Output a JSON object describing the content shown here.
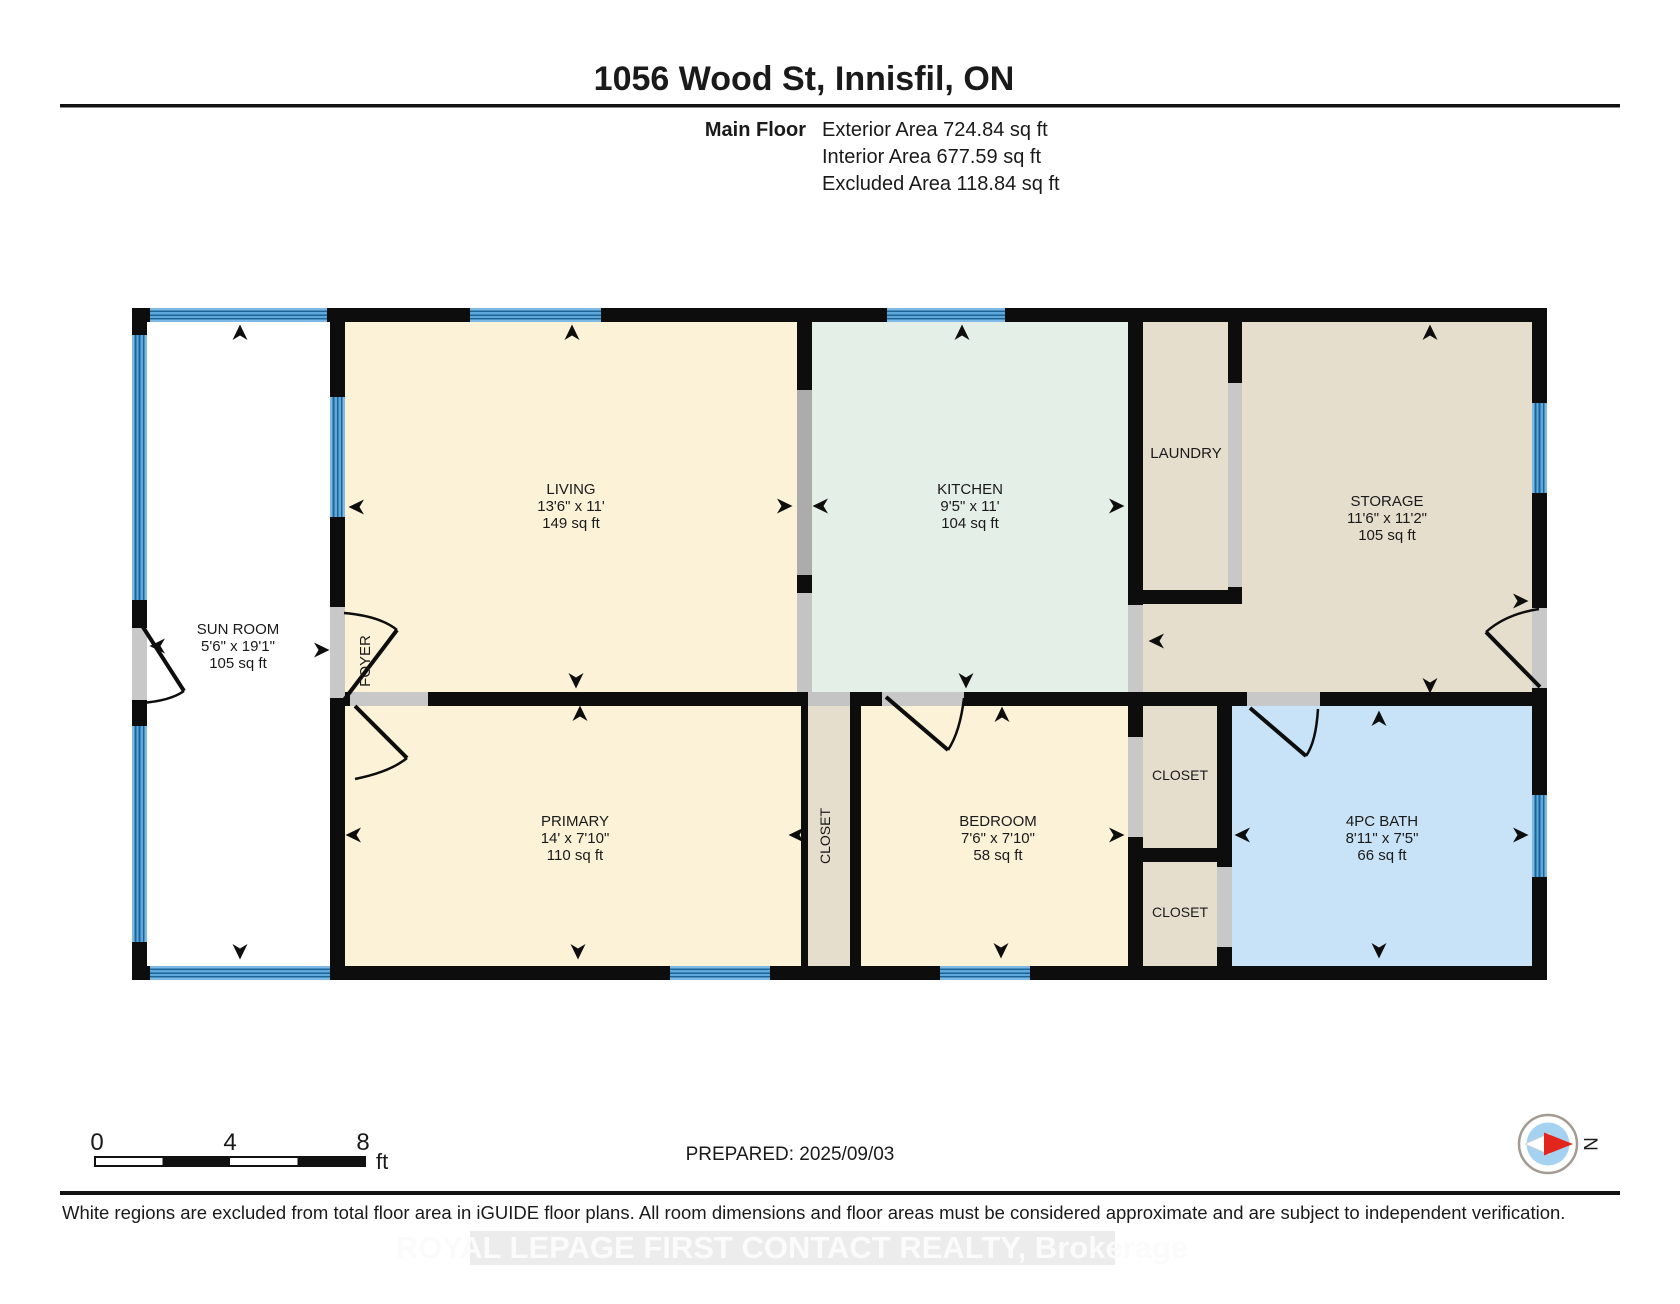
{
  "header": {
    "title": "1056 Wood St, Innisfil, ON",
    "floor_label": "Main Floor",
    "stats": {
      "exterior": "Exterior Area 724.84 sq ft",
      "interior": "Interior Area 677.59 sq ft",
      "excluded": "Excluded Area 118.84 sq ft"
    }
  },
  "rooms": {
    "sun_room": {
      "name": "SUN ROOM",
      "dims": "5'6\" x 19'1\"",
      "area": "105 sq ft"
    },
    "living": {
      "name": "LIVING",
      "dims": "13'6\" x 11'",
      "area": "149 sq ft"
    },
    "foyer": {
      "name": "FOYER"
    },
    "kitchen": {
      "name": "KITCHEN",
      "dims": "9'5\" x 11'",
      "area": "104 sq ft"
    },
    "laundry": {
      "name": "LAUNDRY"
    },
    "storage": {
      "name": "STORAGE",
      "dims": "11'6\" x 11'2\"",
      "area": "105 sq ft"
    },
    "primary": {
      "name": "PRIMARY",
      "dims": "14' x 7'10\"",
      "area": "110 sq ft"
    },
    "closet_middle": {
      "name": "CLOSET"
    },
    "bedroom": {
      "name": "BEDROOM",
      "dims": "7'6\" x 7'10\"",
      "area": "58 sq ft"
    },
    "closet_upper": {
      "name": "CLOSET"
    },
    "closet_lower": {
      "name": "CLOSET"
    },
    "bath": {
      "name": "4PC BATH",
      "dims": "8'11\" x 7'5\"",
      "area": "66 sq ft"
    }
  },
  "scale_bar": {
    "ticks": [
      "0",
      "4",
      "8"
    ],
    "unit": "ft"
  },
  "prepared_label": "PREPARED: 2025/09/03",
  "compass": {
    "north_label": "N"
  },
  "footer": {
    "disclaimer": "White regions are excluded from total floor area in iGUIDE floor plans. All room dimensions and floor areas must be considered approximate and are subject to independent verification."
  },
  "watermark": "ROYAL LEPAGE FIRST CONTACT REALTY, Brokerage",
  "colors": {
    "wall": "#0d0d0d",
    "room_cream": "#FBF2D7",
    "room_mint": "#E4EFE8",
    "room_tan": "#E6DECD",
    "room_bath_blue": "#C8E3F7",
    "excluded_white": "#FFFFFF",
    "window_blue": "#5FA8DC",
    "window_stripe": "#1C6396",
    "opening_gray": "#C8C8C8",
    "cased_opening_gray": "#ACACAC",
    "compass_red": "#E3261D",
    "compass_blue": "#A6D2F2"
  }
}
